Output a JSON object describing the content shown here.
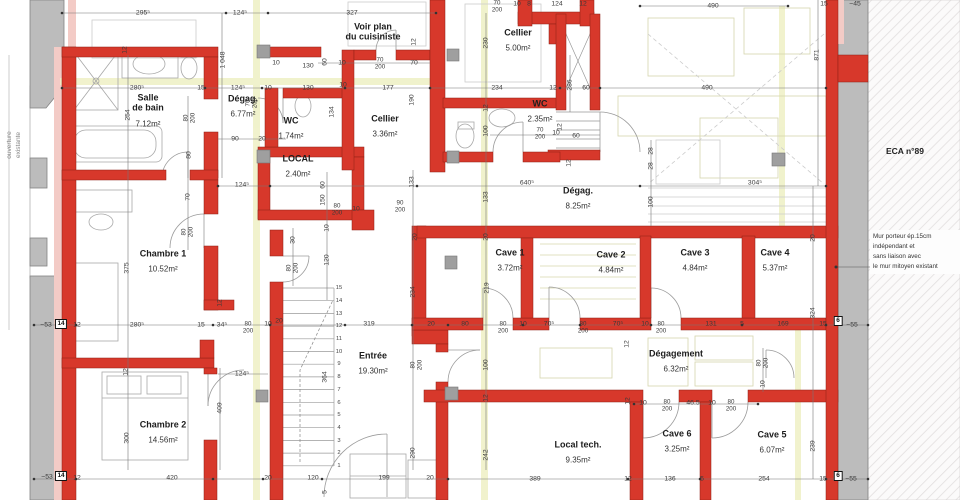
{
  "palette": {
    "wall_new": "#d7382b",
    "wall_existing": "#bcbcbc",
    "lining_pink": "#f3cbc6",
    "section_yellow": "#eef0c4",
    "dim_text": "#3a3a3a"
  },
  "notes": {
    "eca": "ECA n°89",
    "wall": "Mur porteur ép.15cm\nindépendant et\nsans liaison avec\nle mur mitoyen existant",
    "opening": "ouverture\nexistante"
  },
  "rooms": [
    {
      "name": "Salle\nde bain",
      "area": "7.12m²",
      "x": 148,
      "y": 112
    },
    {
      "name": "Dégag.",
      "area": "6.77m²",
      "x": 243,
      "y": 108
    },
    {
      "name": "WC",
      "area": "1.74m²",
      "x": 291,
      "y": 130
    },
    {
      "name": "LOCAL",
      "area": "2.40m²",
      "x": 298,
      "y": 168
    },
    {
      "name": "Cellier",
      "area": "3.36m²",
      "x": 385,
      "y": 128
    },
    {
      "name": "Voir plan\ndu cuisiniste",
      "area": "",
      "x": 373,
      "y": 32
    },
    {
      "name": "Cellier",
      "area": "5.00m²",
      "x": 518,
      "y": 42
    },
    {
      "name": "WC",
      "area": "2.35m²",
      "x": 540,
      "y": 113
    },
    {
      "name": "Dégag.",
      "area": "8.25m²",
      "x": 578,
      "y": 200
    },
    {
      "name": "Cave 1",
      "area": "3.72m²",
      "x": 510,
      "y": 262
    },
    {
      "name": "Cave 2",
      "area": "4.84m²",
      "x": 611,
      "y": 264
    },
    {
      "name": "Cave 3",
      "area": "4.84m²",
      "x": 695,
      "y": 262
    },
    {
      "name": "Cave 4",
      "area": "5.37m²",
      "x": 775,
      "y": 262
    },
    {
      "name": "Chambre 1",
      "area": "10.52m²",
      "x": 163,
      "y": 263
    },
    {
      "name": "Chambre 2",
      "area": "14.56m²",
      "x": 163,
      "y": 434
    },
    {
      "name": "Entrée",
      "area": "19.30m²",
      "x": 373,
      "y": 365
    },
    {
      "name": "Dégagement",
      "area": "6.32m²",
      "x": 676,
      "y": 363
    },
    {
      "name": "Local tech.",
      "area": "9.35m²",
      "x": 578,
      "y": 454
    },
    {
      "name": "Cave 6",
      "area": "3.25m²",
      "x": 677,
      "y": 443
    },
    {
      "name": "Cave 5",
      "area": "6.07m²",
      "x": 772,
      "y": 444
    }
  ],
  "dims": [
    {
      "t": "295⁵",
      "x": 143,
      "y": 13
    },
    {
      "t": "124⁵",
      "x": 240,
      "y": 13
    },
    {
      "t": "327",
      "x": 352,
      "y": 13
    },
    {
      "t": "70/200",
      "x": 497,
      "y": 7
    },
    {
      "t": "10",
      "x": 517,
      "y": 4
    },
    {
      "t": "8",
      "x": 529,
      "y": 4
    },
    {
      "t": "124",
      "x": 557,
      "y": 4
    },
    {
      "t": "12",
      "x": 583,
      "y": 4
    },
    {
      "t": "490",
      "x": 713,
      "y": 6
    },
    {
      "t": "15",
      "x": 824,
      "y": 4
    },
    {
      "t": "~45",
      "x": 855,
      "y": 4
    },
    {
      "t": "871",
      "x": 817,
      "y": 55,
      "r": 1
    },
    {
      "t": "490",
      "x": 707,
      "y": 88
    },
    {
      "t": "1 048",
      "x": 223,
      "y": 60,
      "r": 1
    },
    {
      "t": "12",
      "x": 125,
      "y": 50,
      "r": 1
    },
    {
      "t": "280⁵",
      "x": 137,
      "y": 88
    },
    {
      "t": "15",
      "x": 201,
      "y": 88
    },
    {
      "t": "124⁵",
      "x": 238,
      "y": 88
    },
    {
      "t": "10",
      "x": 268,
      "y": 88
    },
    {
      "t": "10",
      "x": 276,
      "y": 63
    },
    {
      "t": "130",
      "x": 308,
      "y": 66
    },
    {
      "t": "130",
      "x": 308,
      "y": 88
    },
    {
      "t": "254",
      "x": 128,
      "y": 115,
      "r": 1
    },
    {
      "t": "80/200",
      "x": 190,
      "y": 118,
      "r": 1
    },
    {
      "t": "80",
      "x": 189,
      "y": 155,
      "r": 1
    },
    {
      "t": "90",
      "x": 235,
      "y": 139
    },
    {
      "t": "20",
      "x": 262,
      "y": 139
    },
    {
      "t": "70/200",
      "x": 252,
      "y": 103,
      "r": 1
    },
    {
      "t": "60",
      "x": 325,
      "y": 62,
      "r": 1
    },
    {
      "t": "10",
      "x": 342,
      "y": 63
    },
    {
      "t": "70/200",
      "x": 380,
      "y": 64
    },
    {
      "t": "70",
      "x": 414,
      "y": 63
    },
    {
      "t": "12",
      "x": 414,
      "y": 42,
      "r": 1
    },
    {
      "t": "177",
      "x": 388,
      "y": 88
    },
    {
      "t": "10",
      "x": 343,
      "y": 85
    },
    {
      "t": "134",
      "x": 332,
      "y": 112,
      "r": 1
    },
    {
      "t": "190",
      "x": 412,
      "y": 100,
      "r": 1
    },
    {
      "t": "230",
      "x": 486,
      "y": 43,
      "r": 1
    },
    {
      "t": "234",
      "x": 497,
      "y": 88
    },
    {
      "t": "12",
      "x": 553,
      "y": 88
    },
    {
      "t": "286",
      "x": 570,
      "y": 85,
      "r": 1
    },
    {
      "t": "60",
      "x": 586,
      "y": 88
    },
    {
      "t": "12",
      "x": 486,
      "y": 108,
      "r": 1
    },
    {
      "t": "100",
      "x": 486,
      "y": 131,
      "r": 1
    },
    {
      "t": "70/200",
      "x": 540,
      "y": 134
    },
    {
      "t": "10",
      "x": 556,
      "y": 133
    },
    {
      "t": "60",
      "x": 576,
      "y": 136
    },
    {
      "t": "12",
      "x": 560,
      "y": 127,
      "r": 1
    },
    {
      "t": "12",
      "x": 569,
      "y": 163,
      "r": 1
    },
    {
      "t": "124⁵",
      "x": 242,
      "y": 185
    },
    {
      "t": "640⁵",
      "x": 527,
      "y": 183
    },
    {
      "t": "304⁵",
      "x": 755,
      "y": 183
    },
    {
      "t": "28",
      "x": 651,
      "y": 151,
      "r": 1
    },
    {
      "t": "28",
      "x": 651,
      "y": 166,
      "r": 1
    },
    {
      "t": "100",
      "x": 651,
      "y": 202,
      "r": 1
    },
    {
      "t": "70",
      "x": 188,
      "y": 197,
      "r": 1
    },
    {
      "t": "80/200",
      "x": 188,
      "y": 232,
      "r": 1
    },
    {
      "t": "375",
      "x": 127,
      "y": 268,
      "r": 1
    },
    {
      "t": "30",
      "x": 293,
      "y": 240,
      "r": 1
    },
    {
      "t": "80/200",
      "x": 293,
      "y": 268,
      "r": 1
    },
    {
      "t": "12",
      "x": 220,
      "y": 303,
      "r": 1
    },
    {
      "t": "133",
      "x": 412,
      "y": 182,
      "r": 1
    },
    {
      "t": "133",
      "x": 486,
      "y": 197,
      "r": 1
    },
    {
      "t": "60",
      "x": 323,
      "y": 185,
      "r": 1
    },
    {
      "t": "150",
      "x": 323,
      "y": 200,
      "r": 1
    },
    {
      "t": "80/200",
      "x": 337,
      "y": 210
    },
    {
      "t": "10",
      "x": 356,
      "y": 209
    },
    {
      "t": "90/200",
      "x": 400,
      "y": 207
    },
    {
      "t": "10",
      "x": 327,
      "y": 228,
      "r": 1
    },
    {
      "t": "20",
      "x": 415,
      "y": 237,
      "r": 1
    },
    {
      "t": "120",
      "x": 327,
      "y": 260,
      "r": 1
    },
    {
      "t": "20",
      "x": 486,
      "y": 237,
      "r": 1
    },
    {
      "t": "219",
      "x": 487,
      "y": 288,
      "r": 1
    },
    {
      "t": "234",
      "x": 413,
      "y": 292,
      "r": 1
    },
    {
      "t": "20",
      "x": 813,
      "y": 238,
      "r": 1
    },
    {
      "t": "324",
      "x": 813,
      "y": 313,
      "r": 1
    },
    {
      "t": "~53",
      "x": 46,
      "y": 325
    },
    {
      "t": "12",
      "x": 77,
      "y": 325
    },
    {
      "t": "280⁵",
      "x": 137,
      "y": 325
    },
    {
      "t": "15",
      "x": 201,
      "y": 325
    },
    {
      "t": "34⁵",
      "x": 222,
      "y": 325
    },
    {
      "t": "80/200",
      "x": 248,
      "y": 328
    },
    {
      "t": "10",
      "x": 268,
      "y": 324
    },
    {
      "t": "20",
      "x": 279,
      "y": 321
    },
    {
      "t": "319",
      "x": 369,
      "y": 324
    },
    {
      "t": "20",
      "x": 431,
      "y": 324
    },
    {
      "t": "80",
      "x": 465,
      "y": 324
    },
    {
      "t": "80/200",
      "x": 503,
      "y": 328
    },
    {
      "t": "10",
      "x": 523,
      "y": 324
    },
    {
      "t": "70⁵",
      "x": 549,
      "y": 324
    },
    {
      "t": "80/200",
      "x": 583,
      "y": 328
    },
    {
      "t": "70⁵",
      "x": 618,
      "y": 324
    },
    {
      "t": "10",
      "x": 645,
      "y": 324
    },
    {
      "t": "80/200",
      "x": 661,
      "y": 328
    },
    {
      "t": "131",
      "x": 711,
      "y": 324
    },
    {
      "t": "5",
      "x": 742,
      "y": 324
    },
    {
      "t": "169",
      "x": 783,
      "y": 324
    },
    {
      "t": "15",
      "x": 823,
      "y": 324
    },
    {
      "t": "~55",
      "x": 852,
      "y": 325
    },
    {
      "t": "12",
      "x": 126,
      "y": 372,
      "r": 1
    },
    {
      "t": "124⁵",
      "x": 242,
      "y": 374
    },
    {
      "t": "409",
      "x": 220,
      "y": 408,
      "r": 1
    },
    {
      "t": "300",
      "x": 127,
      "y": 438,
      "r": 1
    },
    {
      "t": "364",
      "x": 325,
      "y": 377,
      "r": 1
    },
    {
      "t": "80/200",
      "x": 417,
      "y": 365,
      "r": 1
    },
    {
      "t": "290",
      "x": 413,
      "y": 453,
      "r": 1
    },
    {
      "t": "100",
      "x": 486,
      "y": 365,
      "r": 1
    },
    {
      "t": "12",
      "x": 486,
      "y": 398,
      "r": 1
    },
    {
      "t": "242",
      "x": 486,
      "y": 455,
      "r": 1
    },
    {
      "t": "12",
      "x": 627,
      "y": 344,
      "r": 1
    },
    {
      "t": "12",
      "x": 628,
      "y": 401,
      "r": 1
    },
    {
      "t": "80/200",
      "x": 763,
      "y": 363,
      "r": 1
    },
    {
      "t": "10",
      "x": 763,
      "y": 384,
      "r": 1
    },
    {
      "t": "10",
      "x": 643,
      "y": 403
    },
    {
      "t": "80/200",
      "x": 667,
      "y": 406
    },
    {
      "t": "46.5",
      "x": 693,
      "y": 403
    },
    {
      "t": "10",
      "x": 712,
      "y": 403
    },
    {
      "t": "80/200",
      "x": 731,
      "y": 406
    },
    {
      "t": "239",
      "x": 813,
      "y": 446,
      "r": 1
    },
    {
      "t": "~53",
      "x": 47,
      "y": 477
    },
    {
      "t": "12",
      "x": 77,
      "y": 478
    },
    {
      "t": "420",
      "x": 172,
      "y": 478
    },
    {
      "t": "20",
      "x": 268,
      "y": 478
    },
    {
      "t": "120",
      "x": 313,
      "y": 478
    },
    {
      "t": "199",
      "x": 384,
      "y": 478
    },
    {
      "t": "20",
      "x": 430,
      "y": 478
    },
    {
      "t": "389",
      "x": 535,
      "y": 479
    },
    {
      "t": "12",
      "x": 628,
      "y": 479
    },
    {
      "t": "136",
      "x": 670,
      "y": 479
    },
    {
      "t": "5",
      "x": 702,
      "y": 479
    },
    {
      "t": "254",
      "x": 764,
      "y": 479
    },
    {
      "t": "15",
      "x": 823,
      "y": 479
    },
    {
      "t": "~55",
      "x": 851,
      "y": 479
    },
    {
      "t": "5",
      "x": 325,
      "y": 492,
      "r": 1
    }
  ],
  "markers": [
    {
      "t": "14",
      "x": 61,
      "y": 324
    },
    {
      "t": "6",
      "x": 838,
      "y": 321
    },
    {
      "t": "14",
      "x": 61,
      "y": 476
    },
    {
      "t": "6",
      "x": 838,
      "y": 476
    }
  ],
  "stair_steps": [
    "1",
    "2",
    "3",
    "4",
    "5",
    "6",
    "7",
    "8",
    "9",
    "10",
    "11",
    "12",
    "13",
    "14",
    "15"
  ]
}
